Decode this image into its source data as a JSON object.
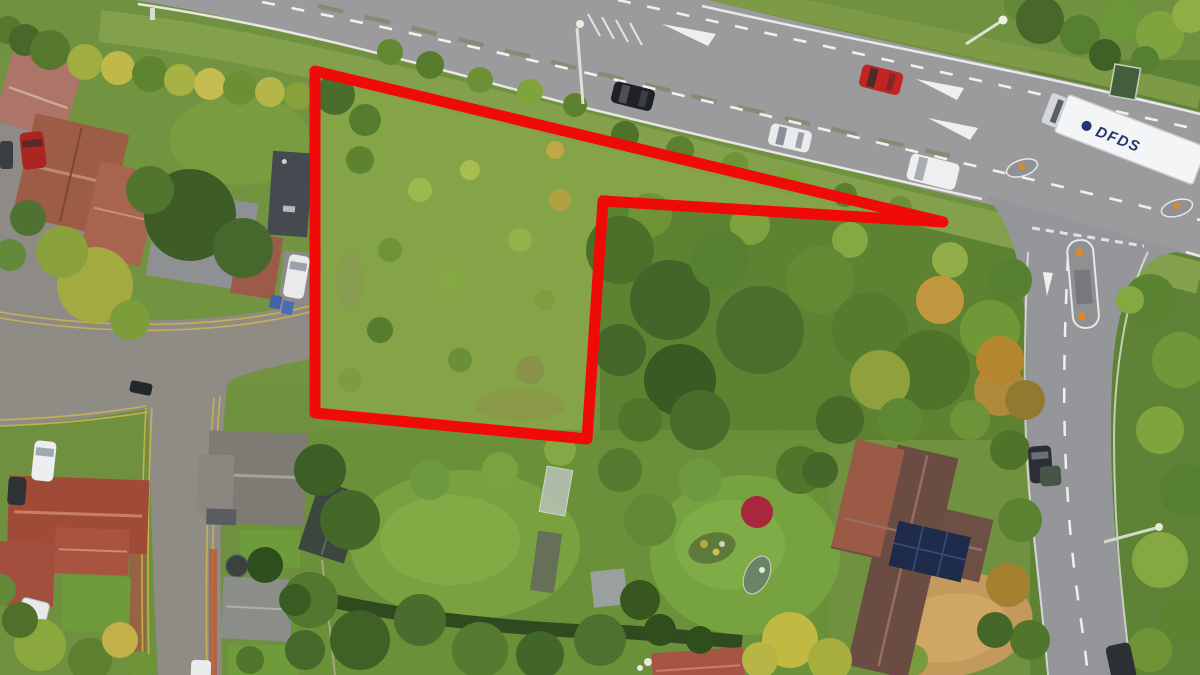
{
  "scene": {
    "description": "Aerial drone photograph of a scrubland building plot outlined in red, beside a main road with traffic to the north, a minor road junction to the east, and residential houses with mature gardens to the west and south",
    "truck_label": "DFDS",
    "boundary": {
      "color": "#f50606",
      "stroke_width": "11",
      "path": "M315,71 L943,222 L603,201 L587,439 L315,413 Z",
      "vertices": "315,71 943,222 603,201 587,439 315,413"
    },
    "colors": {
      "main_road": "#9b9b9d",
      "side_road": "#95969a",
      "street": "#8f8c86",
      "grass_base": "#6f9140",
      "plot_scrub": "#84a447",
      "woodland": "#5d8232",
      "marking_white": "#f0f0ee",
      "yellow_line": "#cdb54e",
      "truck_body": "#f4f5f6",
      "truck_text": "#22356e",
      "solar_panel": "#1f2b4a",
      "red_maple": "#a8273d",
      "bollard_orange": "#d98a2c"
    },
    "vehicles": [
      "dark car on main road",
      "red car on main road",
      "white car on main road",
      "white van on main road",
      "white DFDS articulated lorry",
      "white car on driveway",
      "red car on driveway",
      "white car on street",
      "dark car on street",
      "dark car on side road",
      "dark car at bottom of side road"
    ]
  }
}
